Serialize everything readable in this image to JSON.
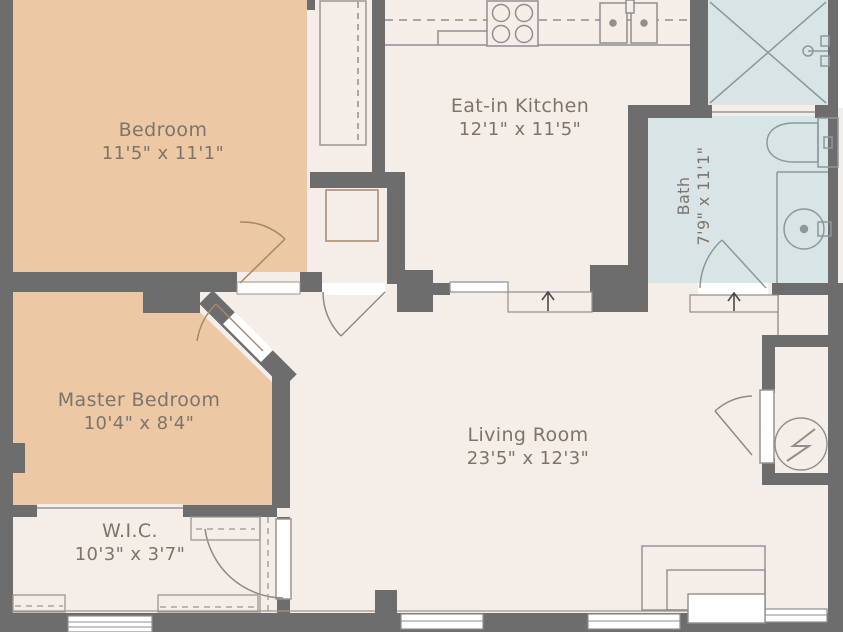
{
  "floorplan": {
    "title": "Apartment floor plan",
    "rooms": [
      {
        "name": "Bedroom",
        "dimensions": "11'5\" x 11'1\""
      },
      {
        "name": "Eat-in Kitchen",
        "dimensions": "12'1\" x 11'5\""
      },
      {
        "name": "Bath",
        "dimensions": "7'9\" x 11'1\""
      },
      {
        "name": "Master Bedroom",
        "dimensions": "10'4\" x 8'4\""
      },
      {
        "name": "W.I.C.",
        "dimensions": "10'3\" x 3'7\""
      },
      {
        "name": "Living Room",
        "dimensions": "23'5\" x 12'3\""
      }
    ],
    "fixtures": [
      "stove-4-burners",
      "double-kitchen-sink",
      "upper-cabinet-dashed-line",
      "bedroom-closet-rod",
      "utility-square",
      "shower-x",
      "shower-head",
      "toilet",
      "vanity-round-sink",
      "bath-door",
      "bedroom-door",
      "master-bedroom-door",
      "kitchen-living-door",
      "wic-door",
      "utility-closet-door",
      "water-heater-circle-bolt",
      "entry-arrow-kitchen",
      "entry-arrow-bath",
      "cased-opening",
      "wic-shelves-dashed-rods",
      "bottom-windows",
      "entry-steps-nested-rectangles"
    ],
    "entry_arrows": [
      {
        "location": "kitchen-living opening",
        "direction": "up"
      },
      {
        "location": "bath-living opening",
        "direction": "up"
      }
    ],
    "colors": {
      "wall": "#6d6d6d",
      "bedroom_fill": "#ecc8a4",
      "bath_fill": "#d9e4e7",
      "floor_fill": "#f5ede8",
      "fixture_line": "#8f8f8f",
      "door_arc_warm": "#a5886a",
      "label_text": "#7d756b",
      "arrow": "#4a4a4a"
    }
  }
}
